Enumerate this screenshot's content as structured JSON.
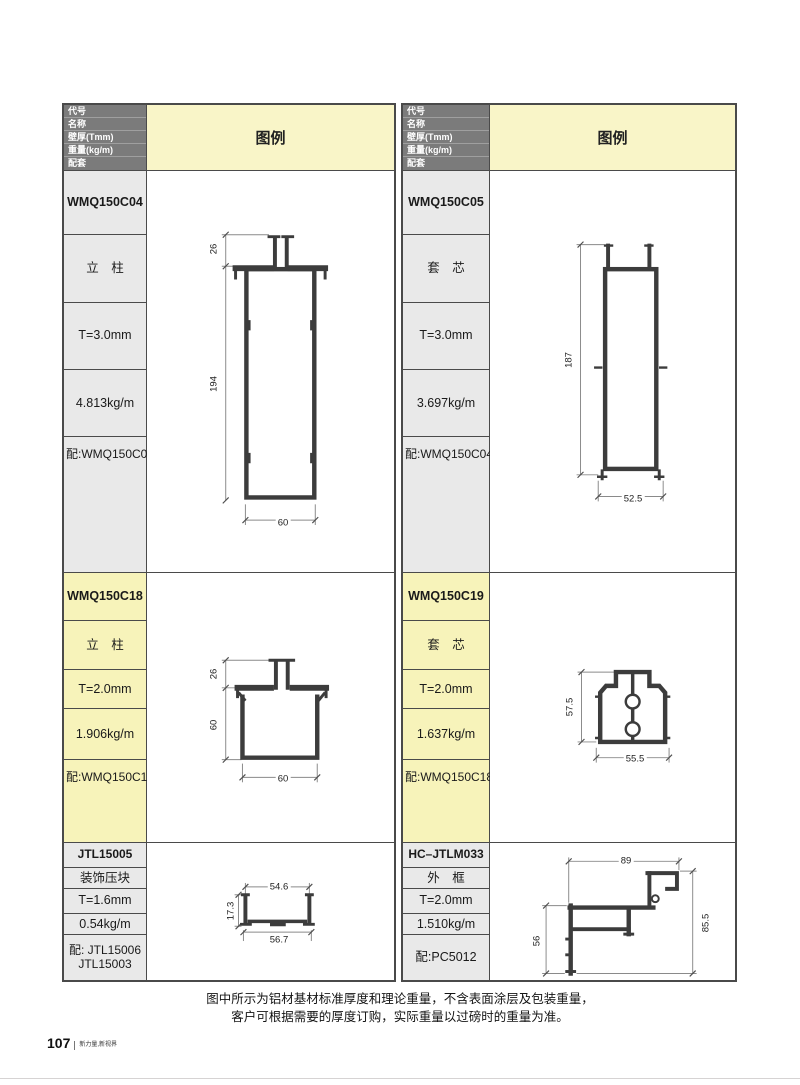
{
  "header": {
    "labels": [
      "代号",
      "名称",
      "壁厚(Tmm)",
      "重量(kg/m)",
      "配套"
    ],
    "legend": "图例"
  },
  "blocks": {
    "l1": {
      "code": "WMQ150C04",
      "name": "立　柱",
      "thickness": "T=3.0mm",
      "weight": "4.813kg/m",
      "match": "配:WMQ150C05",
      "dims": {
        "top": "26",
        "height": "194",
        "width": "60"
      }
    },
    "r1": {
      "code": "WMQ150C05",
      "name": "套　芯",
      "thickness": "T=3.0mm",
      "weight": "3.697kg/m",
      "match": "配:WMQ150C04",
      "dims": {
        "height": "187",
        "width": "52.5"
      }
    },
    "l2": {
      "code": "WMQ150C18",
      "name": "立　柱",
      "thickness": "T=2.0mm",
      "weight": "1.906kg/m",
      "match": "配:WMQ150C19",
      "dims": {
        "top": "26",
        "height": "60",
        "width": "60"
      }
    },
    "r2": {
      "code": "WMQ150C19",
      "name": "套　芯",
      "thickness": "T=2.0mm",
      "weight": "1.637kg/m",
      "match": "配:WMQ150C18",
      "dims": {
        "height": "57.5",
        "width": "55.5"
      }
    },
    "l3": {
      "code": "JTL15005",
      "name": "装饰压块",
      "thickness": "T=1.6mm",
      "weight": "0.54kg/m",
      "match_line1": "配: JTL15006",
      "match_line2": "JTL15003",
      "dims": {
        "top": "54.6",
        "height": "17.3",
        "width": "56.7"
      }
    },
    "r3": {
      "code": "HC–JTLM033",
      "name": "外　框",
      "thickness": "T=2.0mm",
      "weight": "1.510kg/m",
      "match": "配:PC5012",
      "dims": {
        "top": "89",
        "left": "56",
        "right": "85.5"
      }
    }
  },
  "note": {
    "line1": "图中所示为铝材基材标准厚度和理论重量，不含表面涂层及包装重量，",
    "line2": "客户可根据需要的厚度订购，实际重量以过磅时的重量为准。"
  },
  "footer": {
    "page_number": "107",
    "slogan": "新力量,新视界"
  },
  "colors": {
    "header_dark": "#7b7b7b",
    "legend_yellow": "#f9f5c8",
    "row_gray": "#e9e9e9",
    "row_yellow": "#f7f3ba",
    "border": "#4a4a4a",
    "profile_stroke": "#3c3c3c"
  }
}
